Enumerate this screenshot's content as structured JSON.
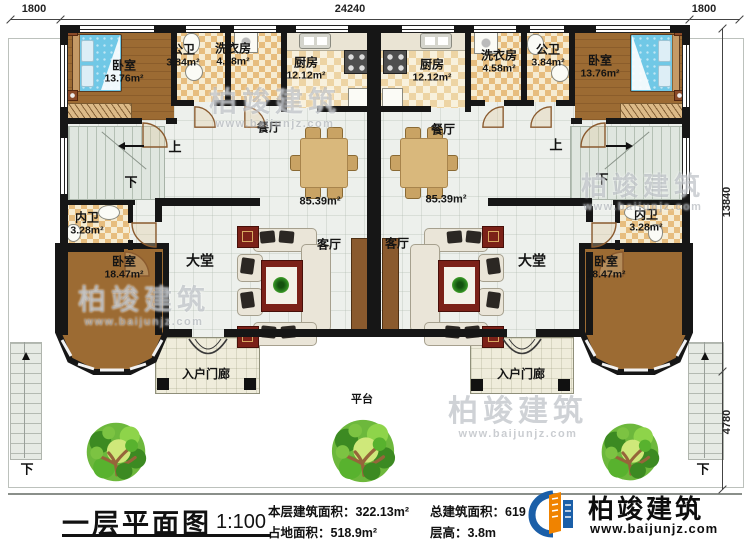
{
  "dims": {
    "left_offset": "1800",
    "building_width": "24240",
    "right_offset": "1800",
    "building_depth": "13840",
    "platform_depth": "4780"
  },
  "rooms": {
    "bedroom_top": {
      "label": "卧室",
      "area": "13.76m²"
    },
    "bedroom_bottom": {
      "label": "卧室",
      "area": "18.47m²"
    },
    "public_bath": {
      "label": "公卫",
      "area": "3.84m²"
    },
    "laundry": {
      "label": "洗衣房",
      "area": "4.58m²"
    },
    "kitchen": {
      "label": "厨房",
      "area": "12.12m²"
    },
    "inner_bath": {
      "label": "内卫",
      "area": "3.28m²"
    },
    "dining": {
      "label": "餐厅"
    },
    "hall": {
      "label": "大堂"
    },
    "living": {
      "label": "客厅"
    },
    "unit_area": "85.39m²",
    "porch": {
      "label": "入户门廊"
    },
    "platform": {
      "label": "平台"
    }
  },
  "stairs": {
    "up": "上",
    "down": "下"
  },
  "title_block": {
    "title": "一层平面图",
    "scale": "1:100",
    "stats": [
      {
        "label": "本层建筑面积：",
        "value": "322.13m²"
      },
      {
        "label": "占地面积：",
        "value": "518.9m²"
      },
      {
        "label": "总建筑面积：",
        "value": "619"
      },
      {
        "label": "层高：",
        "value": "3.8m"
      }
    ]
  },
  "logo": {
    "name": "柏竣建筑",
    "site": "www.baijunjz.com"
  },
  "watermark": {
    "name": "柏竣建筑",
    "site": "www.baijunjz.com"
  },
  "colors": {
    "wall": "#161616",
    "wood": "#9c6b33",
    "bed": "#70c8e6",
    "logo_blue": "#1b5fa8",
    "logo_orange": "#f08300"
  }
}
